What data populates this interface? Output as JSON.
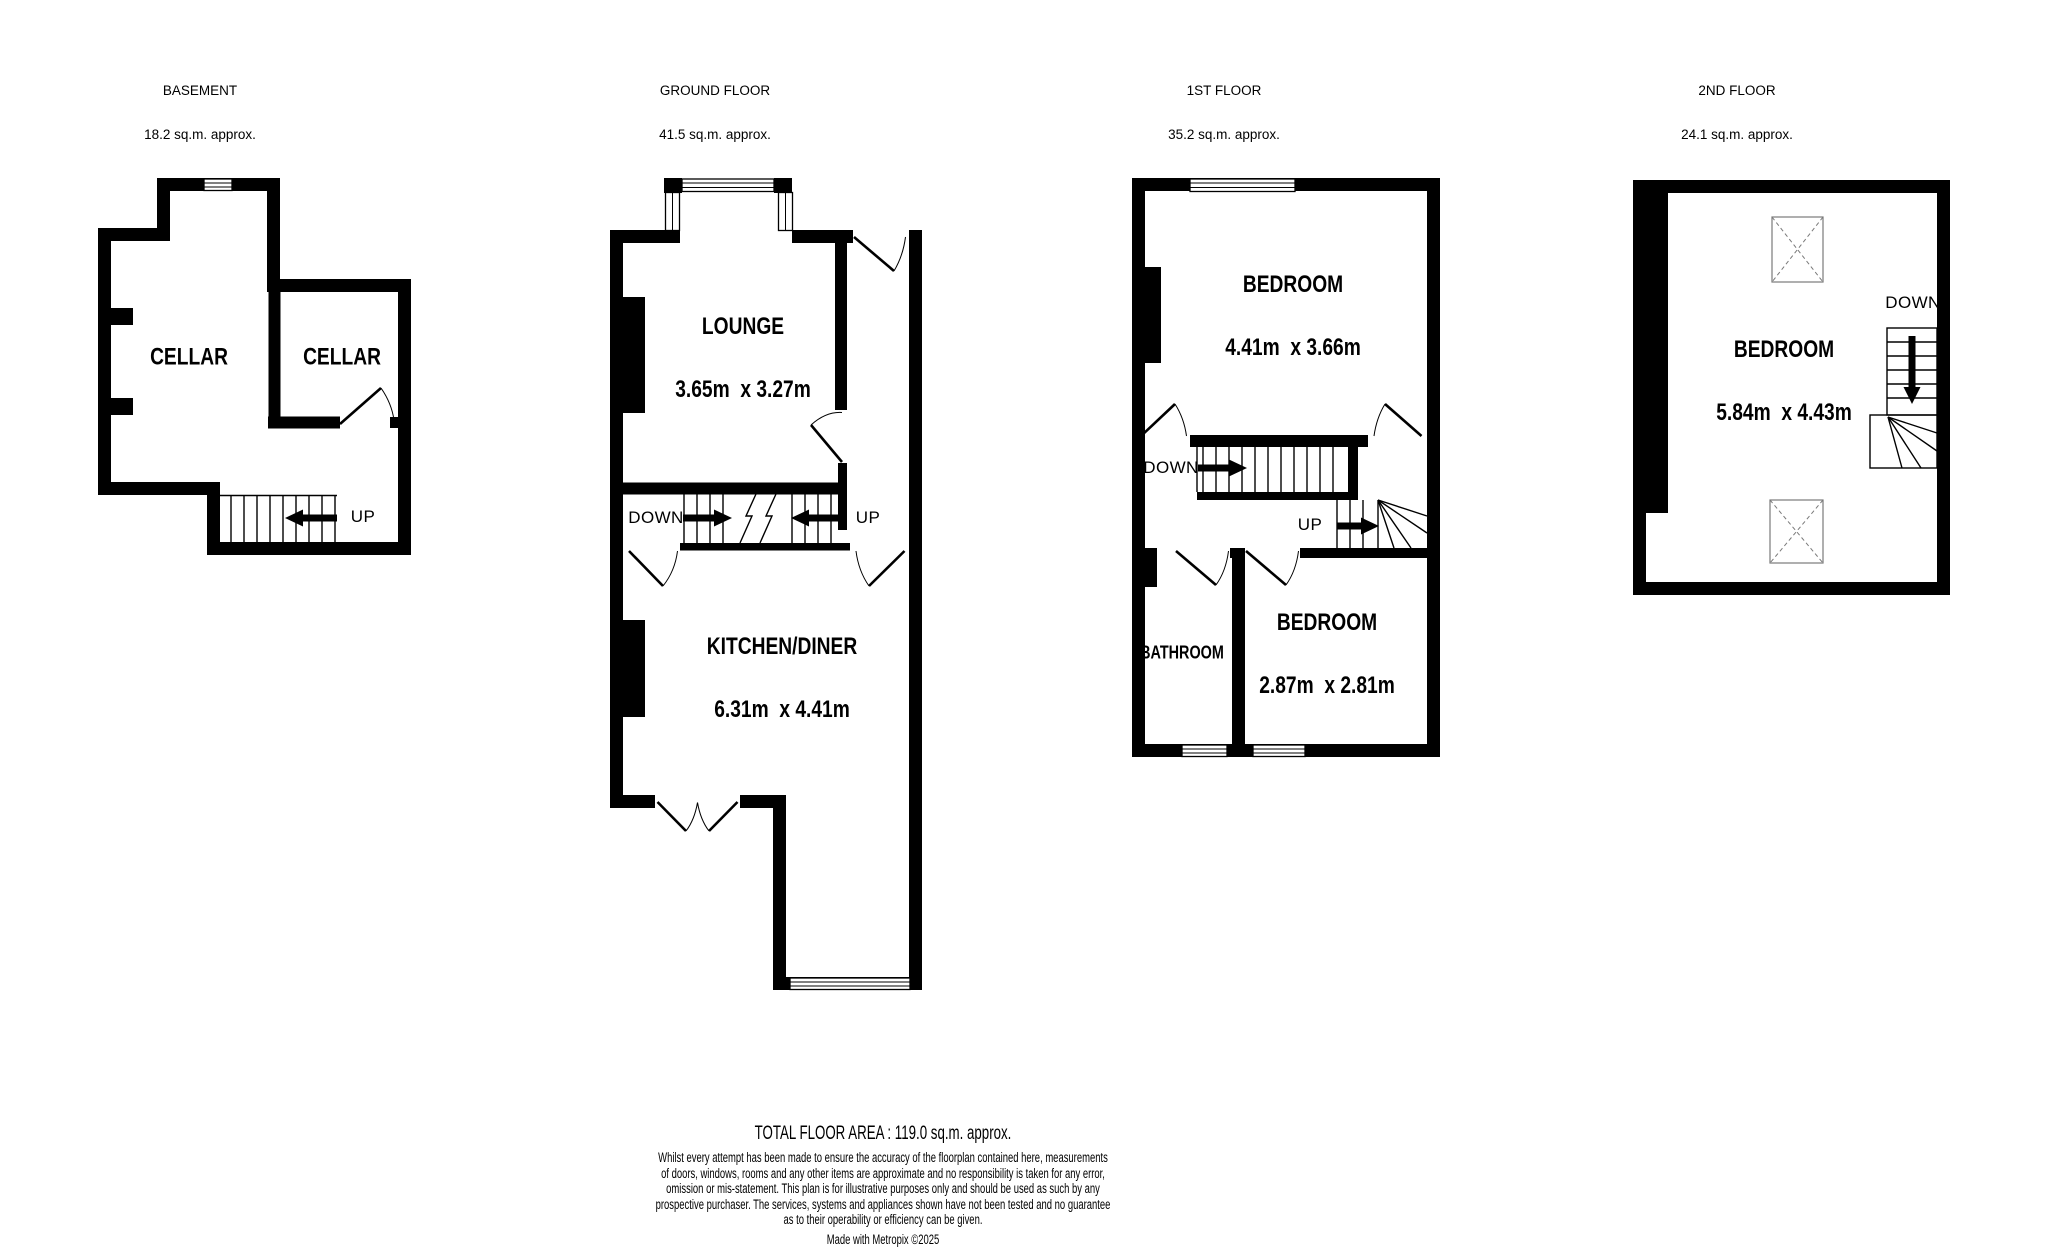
{
  "page": {
    "background": "#ffffff",
    "wall_color": "#000000",
    "skylight_color": "#7a7a7a"
  },
  "floors": [
    {
      "title": "BASEMENT",
      "area": "18.2 sq.m. approx.",
      "rooms": [
        {
          "name": "CELLAR"
        },
        {
          "name": "CELLAR"
        }
      ],
      "stairs": [
        {
          "label": "UP",
          "arrow": "left-arrow-icon"
        }
      ]
    },
    {
      "title": "GROUND FLOOR",
      "area": "41.5 sq.m. approx.",
      "rooms": [
        {
          "name": "LOUNGE",
          "dims": "3.65m  x 3.27m"
        },
        {
          "name": "KITCHEN/DINER",
          "dims": "6.31m  x 4.41m"
        }
      ],
      "stairs": [
        {
          "label": "DOWN",
          "arrow": "right-arrow-icon"
        },
        {
          "label": "UP",
          "arrow": "left-arrow-icon"
        }
      ]
    },
    {
      "title": "1ST FLOOR",
      "area": "35.2 sq.m. approx.",
      "rooms": [
        {
          "name": "BEDROOM",
          "dims": "4.41m  x 3.66m"
        },
        {
          "name": "BATHROOM"
        },
        {
          "name": "BEDROOM",
          "dims": "2.87m  x 2.81m"
        }
      ],
      "stairs": [
        {
          "label": "DOWN",
          "arrow": "right-arrow-icon"
        },
        {
          "label": "UP",
          "arrow": "right-arrow-icon"
        }
      ]
    },
    {
      "title": "2ND FLOOR",
      "area": "24.1 sq.m. approx.",
      "rooms": [
        {
          "name": "BEDROOM",
          "dims": "5.84m  x 4.43m"
        }
      ],
      "stairs": [
        {
          "label": "DOWN",
          "arrow": "down-arrow-icon"
        }
      ]
    }
  ],
  "footer": {
    "total": "TOTAL FLOOR AREA : 119.0 sq.m. approx.",
    "disclaimer_lines": [
      "Whilst every attempt has been made to ensure the accuracy of the floorplan contained here, measurements",
      "of doors, windows, rooms and any other items are approximate and no responsibility is taken for any error,",
      "omission or mis-statement. This plan is for illustrative purposes only and should be used as such by any",
      "prospective purchaser. The services, systems and appliances shown have not been tested and no guarantee",
      "as to their operability or efficiency can be given."
    ],
    "credit": "Made with Metropix ©2025"
  }
}
